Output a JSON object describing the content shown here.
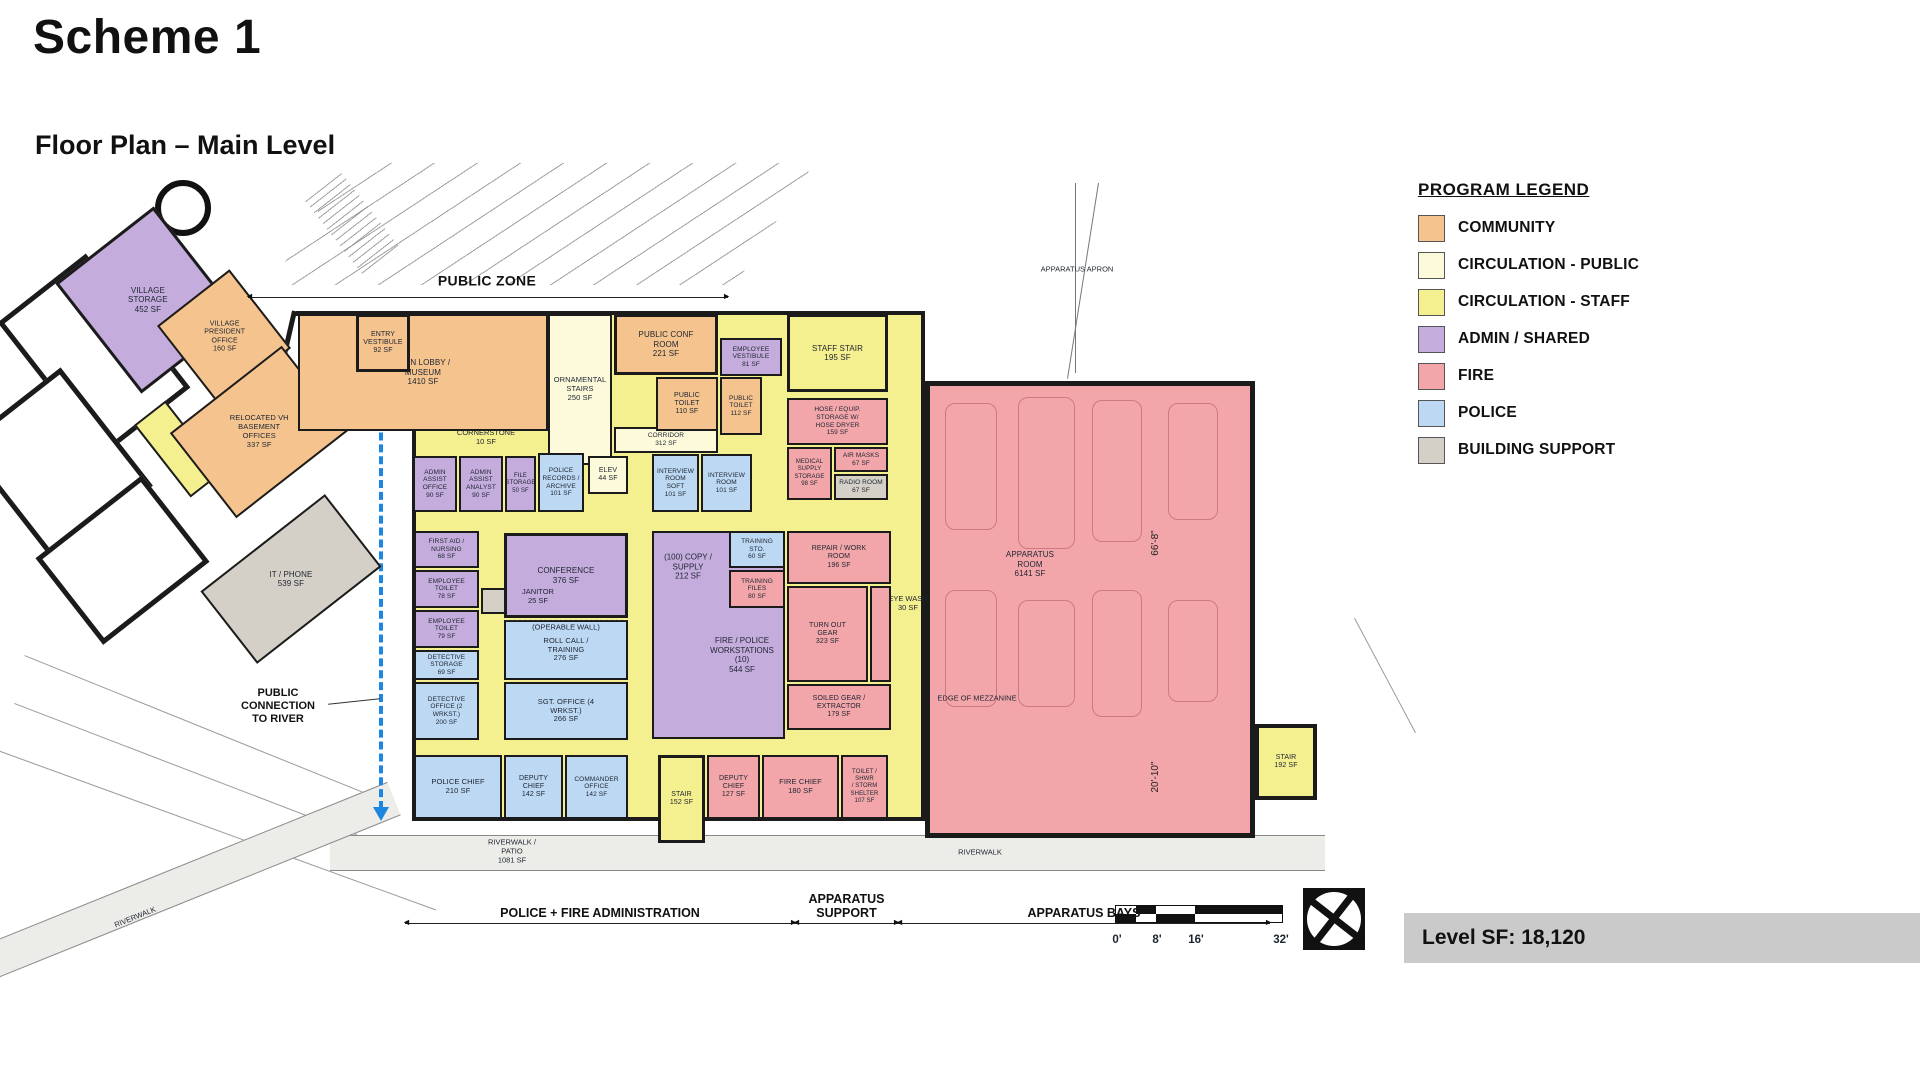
{
  "header": {
    "title": "Scheme 1",
    "subtitle": "Floor Plan – Main Level"
  },
  "footer": {
    "level_sf": "Level SF: 18,120"
  },
  "colors": {
    "community": "#F5C38E",
    "circ_public": "#FCFADB",
    "circ_staff": "#F4EF8F",
    "admin": "#C4ACDC",
    "fire": "#F3A6AA",
    "police": "#BCD8F3",
    "support": "#D4D0C7",
    "white": "#FFFFFF",
    "route_accent": "#1D86E0"
  },
  "legend": {
    "title": "PROGRAM LEGEND",
    "items": [
      {
        "key": "community",
        "label": "COMMUNITY"
      },
      {
        "key": "circ_public",
        "label": "CIRCULATION - PUBLIC"
      },
      {
        "key": "circ_staff",
        "label": "CIRCULATION - STAFF"
      },
      {
        "key": "admin",
        "label": "ADMIN / SHARED"
      },
      {
        "key": "fire",
        "label": "FIRE"
      },
      {
        "key": "police",
        "label": "POLICE"
      },
      {
        "key": "support",
        "label": "BUILDING SUPPORT"
      }
    ]
  },
  "scale_bar": {
    "ticks": [
      "0'",
      "8'",
      "16'",
      "32'"
    ]
  },
  "plan": {
    "rooms": [
      {
        "id": "circulation-staff-base",
        "label": "",
        "sf": "",
        "cat": "circ_staff",
        "x": 382,
        "y": 136,
        "w": 513,
        "h": 510,
        "wall": 4
      },
      {
        "id": "existing-hall-room-1",
        "label": "",
        "sf": "",
        "cat": "white",
        "x": 8,
        "y": 95,
        "w": 112,
        "h": 170,
        "rot": -38,
        "wall": 5
      },
      {
        "id": "existing-hall-room-2",
        "label": "",
        "sf": "",
        "cat": "white",
        "x": -35,
        "y": 215,
        "w": 125,
        "h": 150,
        "rot": -38,
        "wall": 5
      },
      {
        "id": "existing-hall-room-3",
        "label": "",
        "sf": "",
        "cat": "white",
        "x": 25,
        "y": 330,
        "w": 135,
        "h": 110,
        "rot": -38,
        "wall": 5
      },
      {
        "id": "village-storage",
        "label": "VILLAGE\nSTORAGE",
        "sf": "452 SF",
        "cat": "admin",
        "x": 55,
        "y": 55,
        "w": 125,
        "h": 140,
        "rot": -38,
        "wall": 3,
        "fs": 8
      },
      {
        "id": "village-president-office",
        "label": "VILLAGE\nPRESIDENT\nOFFICE",
        "sf": "160 SF",
        "cat": "community",
        "x": 148,
        "y": 112,
        "w": 92,
        "h": 100,
        "rot": -38,
        "fs": 7
      },
      {
        "id": "circ-staff-sliver",
        "label": "",
        "sf": "",
        "cat": "circ_staff",
        "x": 128,
        "y": 228,
        "w": 40,
        "h": 92,
        "rot": -38
      },
      {
        "id": "relocated-vh-basement-offices",
        "label": "RELOCATED VH\nBASEMENT\nOFFICES",
        "sf": "337 SF",
        "cat": "community",
        "x": 158,
        "y": 203,
        "w": 142,
        "h": 108,
        "rot": -38,
        "fs": 7.5
      },
      {
        "id": "it-phone",
        "label": "IT / PHONE",
        "sf": "539 SF",
        "cat": "support",
        "x": 182,
        "y": 358,
        "w": 158,
        "h": 92,
        "rot": -38,
        "fs": 8
      },
      {
        "id": "main-lobby-museum",
        "label": "MAIN LOBBY /\nMUSEUM",
        "sf": "1410 SF",
        "cat": "community",
        "x": 268,
        "y": 139,
        "w": 250,
        "h": 117,
        "fs": 8
      },
      {
        "id": "entry-vestibule",
        "label": "ENTRY\nVESTIBULE",
        "sf": "92 SF",
        "cat": "community",
        "x": 326,
        "y": 139,
        "w": 54,
        "h": 58,
        "wall": 3,
        "fs": 7
      },
      {
        "id": "ornamental-stairs",
        "label": "ORNAMENTAL\nSTAIRS",
        "sf": "250 SF",
        "cat": "circ_public",
        "x": 518,
        "y": 139,
        "w": 64,
        "h": 151,
        "fs": 7.5
      },
      {
        "id": "public-conf-room",
        "label": "PUBLIC CONF\nROOM",
        "sf": "221 SF",
        "cat": "community",
        "x": 584,
        "y": 139,
        "w": 104,
        "h": 61,
        "wall": 3,
        "fs": 8
      },
      {
        "id": "employee-vestibule",
        "label": "EMPLOYEE\nVESTIBULE",
        "sf": "81 SF",
        "cat": "admin",
        "x": 690,
        "y": 163,
        "w": 62,
        "h": 38,
        "fs": 6.5
      },
      {
        "id": "corridor",
        "label": "CORRIDOR",
        "sf": "312 SF",
        "cat": "circ_public",
        "x": 584,
        "y": 252,
        "w": 104,
        "h": 26,
        "fs": 6.5
      },
      {
        "id": "public-toilet-1",
        "label": "PUBLIC\nTOILET",
        "sf": "110 SF",
        "cat": "community",
        "x": 626,
        "y": 202,
        "w": 62,
        "h": 54,
        "fs": 7
      },
      {
        "id": "public-toilet-2",
        "label": "PUBLIC\nTOILET",
        "sf": "112 SF",
        "cat": "community",
        "x": 690,
        "y": 202,
        "w": 42,
        "h": 58,
        "fs": 6.5
      },
      {
        "id": "staff-stair",
        "label": "STAFF STAIR",
        "sf": "195 SF",
        "cat": "circ_staff",
        "x": 757,
        "y": 139,
        "w": 101,
        "h": 78,
        "wall": 3,
        "fs": 8
      },
      {
        "id": "hose-equip-storage",
        "label": "HOSE / EQUIP.\nSTORAGE W/\nHOSE DRYER",
        "sf": "159 SF",
        "cat": "fire",
        "x": 757,
        "y": 223,
        "w": 101,
        "h": 47,
        "fs": 6.5
      },
      {
        "id": "medical-supply-storage",
        "label": "MEDICAL\nSUPPLY\nSTORAGE",
        "sf": "98 SF",
        "cat": "fire",
        "x": 757,
        "y": 272,
        "w": 45,
        "h": 53,
        "fs": 6
      },
      {
        "id": "air-masks",
        "label": "AIR MASKS",
        "sf": "67 SF",
        "cat": "fire",
        "x": 804,
        "y": 272,
        "w": 54,
        "h": 25,
        "fs": 6.5
      },
      {
        "id": "radio-room",
        "label": "RADIO ROOM",
        "sf": "67 SF",
        "cat": "support",
        "x": 804,
        "y": 299,
        "w": 54,
        "h": 26,
        "fs": 6.5
      },
      {
        "id": "admin-assist-office",
        "label": "ADMIN\nASSIST\nOFFICE",
        "sf": "90 SF",
        "cat": "admin",
        "x": 383,
        "y": 281,
        "w": 44,
        "h": 56,
        "fs": 6.5
      },
      {
        "id": "admin-assist-analyst",
        "label": "ADMIN\nASSIST\nANALYST",
        "sf": "90 SF",
        "cat": "admin",
        "x": 429,
        "y": 281,
        "w": 44,
        "h": 56,
        "fs": 6.5
      },
      {
        "id": "file-storage",
        "label": "FILE\nSTORAGE",
        "sf": "50 SF",
        "cat": "admin",
        "x": 475,
        "y": 281,
        "w": 31,
        "h": 56,
        "fs": 6
      },
      {
        "id": "police-records-archive",
        "label": "POLICE\nRECORDS /\nARCHIVE",
        "sf": "101 SF",
        "cat": "police",
        "x": 508,
        "y": 278,
        "w": 46,
        "h": 59,
        "fs": 6.5
      },
      {
        "id": "elevator",
        "label": "ELEV",
        "sf": "44 SF",
        "cat": "circ_public",
        "x": 558,
        "y": 281,
        "w": 40,
        "h": 38,
        "fs": 7
      },
      {
        "id": "interview-room-soft",
        "label": "INTERVIEW\nROOM\nSOFT",
        "sf": "101 SF",
        "cat": "police",
        "x": 622,
        "y": 279,
        "w": 47,
        "h": 58,
        "fs": 6.5
      },
      {
        "id": "interview-room",
        "label": "INTERVIEW\nROOM",
        "sf": "101 SF",
        "cat": "police",
        "x": 671,
        "y": 279,
        "w": 51,
        "h": 58,
        "fs": 6.5
      },
      {
        "id": "first-aid-nursing",
        "label": "FIRST AID /\nNURSING",
        "sf": "68 SF",
        "cat": "admin",
        "x": 384,
        "y": 356,
        "w": 65,
        "h": 37,
        "fs": 6.5
      },
      {
        "id": "employee-toilet-1",
        "label": "EMPLOYEE\nTOILET",
        "sf": "78 SF",
        "cat": "admin",
        "x": 384,
        "y": 395,
        "w": 65,
        "h": 38,
        "fs": 6.5
      },
      {
        "id": "employee-toilet-2",
        "label": "EMPLOYEE\nTOILET",
        "sf": "79 SF",
        "cat": "admin",
        "x": 384,
        "y": 435,
        "w": 65,
        "h": 38,
        "fs": 6.5
      },
      {
        "id": "janitor-closet",
        "label": "",
        "sf": "",
        "cat": "support",
        "x": 451,
        "y": 413,
        "w": 26,
        "h": 26
      },
      {
        "id": "detective-storage",
        "label": "DETECTIVE\nSTORAGE",
        "sf": "69 SF",
        "cat": "police",
        "x": 384,
        "y": 475,
        "w": 65,
        "h": 30,
        "fs": 6.5
      },
      {
        "id": "detective-office",
        "label": "DETECTIVE\nOFFICE (2\nWRKST.)",
        "sf": "200 SF",
        "cat": "police",
        "x": 384,
        "y": 507,
        "w": 65,
        "h": 58,
        "fs": 6.5
      },
      {
        "id": "conference",
        "label": "CONFERENCE",
        "sf": "376 SF",
        "cat": "admin",
        "x": 474,
        "y": 358,
        "w": 124,
        "h": 85,
        "wall": 3,
        "fs": 8
      },
      {
        "id": "roll-call-training",
        "label": "ROLL CALL /\nTRAINING",
        "sf": "276 SF",
        "cat": "police",
        "x": 474,
        "y": 445,
        "w": 124,
        "h": 60,
        "fs": 7.5
      },
      {
        "id": "sgt-office",
        "label": "SGT. OFFICE (4\nWRKST.)",
        "sf": "266 SF",
        "cat": "police",
        "x": 474,
        "y": 507,
        "w": 124,
        "h": 58,
        "fs": 7.5
      },
      {
        "id": "copy-supply-workstations",
        "label": "",
        "sf": "",
        "cat": "admin",
        "x": 622,
        "y": 356,
        "w": 133,
        "h": 208
      },
      {
        "id": "training-storage",
        "label": "TRAINING\nSTO.",
        "sf": "60 SF",
        "cat": "police",
        "x": 699,
        "y": 356,
        "w": 56,
        "h": 37,
        "fs": 6.5
      },
      {
        "id": "training-files",
        "label": "TRAINING\nFILES",
        "sf": "80 SF",
        "cat": "fire",
        "x": 699,
        "y": 395,
        "w": 56,
        "h": 38,
        "fs": 6.5
      },
      {
        "id": "repair-work-room",
        "label": "REPAIR / WORK\nROOM",
        "sf": "196 SF",
        "cat": "fire",
        "x": 757,
        "y": 356,
        "w": 104,
        "h": 53,
        "fs": 7
      },
      {
        "id": "turn-out-gear",
        "label": "TURN OUT\nGEAR",
        "sf": "323 SF",
        "cat": "fire",
        "x": 757,
        "y": 411,
        "w": 81,
        "h": 96,
        "fs": 7
      },
      {
        "id": "eye-wash-alcove",
        "label": "",
        "sf": "",
        "cat": "fire",
        "x": 840,
        "y": 411,
        "w": 21,
        "h": 96
      },
      {
        "id": "soiled-gear-extractor",
        "label": "SOILED GEAR /\nEXTRACTOR",
        "sf": "179 SF",
        "cat": "fire",
        "x": 757,
        "y": 509,
        "w": 104,
        "h": 46,
        "fs": 7
      },
      {
        "id": "apparatus-room",
        "label": "APPARATUS\nROOM",
        "sf": "6141 SF",
        "cat": "fire",
        "x": 895,
        "y": 206,
        "w": 330,
        "h": 457,
        "wall": 5,
        "fs": 8,
        "lx": -60,
        "ly": -45
      },
      {
        "id": "stair-192",
        "label": "STAIR",
        "sf": "192 SF",
        "cat": "circ_staff",
        "x": 1225,
        "y": 549,
        "w": 62,
        "h": 76,
        "wall": 4,
        "fs": 7
      },
      {
        "id": "police-chief",
        "label": "POLICE CHIEF",
        "sf": "210 SF",
        "cat": "police",
        "x": 384,
        "y": 580,
        "w": 88,
        "h": 64,
        "fs": 7.5
      },
      {
        "id": "deputy-chief-police",
        "label": "DEPUTY\nCHIEF",
        "sf": "142 SF",
        "cat": "police",
        "x": 474,
        "y": 580,
        "w": 59,
        "h": 64,
        "fs": 7
      },
      {
        "id": "commander-office",
        "label": "COMMANDER\nOFFICE",
        "sf": "142 SF",
        "cat": "police",
        "x": 535,
        "y": 580,
        "w": 63,
        "h": 64,
        "fs": 6.5
      },
      {
        "id": "stair-152",
        "label": "STAIR",
        "sf": "152 SF",
        "cat": "circ_staff",
        "x": 628,
        "y": 580,
        "w": 47,
        "h": 88,
        "wall": 3,
        "fs": 7
      },
      {
        "id": "deputy-chief-fire",
        "label": "DEPUTY\nCHIEF",
        "sf": "127 SF",
        "cat": "fire",
        "x": 677,
        "y": 580,
        "w": 53,
        "h": 64,
        "fs": 7
      },
      {
        "id": "fire-chief",
        "label": "FIRE CHIEF",
        "sf": "180 SF",
        "cat": "fire",
        "x": 732,
        "y": 580,
        "w": 77,
        "h": 64,
        "fs": 7.5
      },
      {
        "id": "toilet-shwr-storm-shelter",
        "label": "TOILET / SHWR\n/ STORM\nSHELTER",
        "sf": "107 SF",
        "cat": "fire",
        "x": 811,
        "y": 580,
        "w": 47,
        "h": 64,
        "fs": 6
      }
    ],
    "annotations": [
      {
        "text": "PUBLIC ZONE",
        "x": 457,
        "y": 106,
        "cls": "zone"
      },
      {
        "text": "APPARATUS APRON",
        "x": 1047,
        "y": 94,
        "cls": "tiny"
      },
      {
        "text": "CORNERSTONE\n10 SF",
        "x": 456,
        "y": 262,
        "cls": "tiny"
      },
      {
        "text": "JANITOR\n25 SF",
        "x": 508,
        "y": 421,
        "cls": "tiny"
      },
      {
        "text": "(OPERABLE WALL)",
        "x": 536,
        "y": 452,
        "cls": "tiny"
      },
      {
        "text": "EYE WASH\n30 SF",
        "x": 878,
        "y": 428,
        "cls": "tiny"
      },
      {
        "text": "(100) COPY /\nSUPPLY\n212 SF",
        "x": 658,
        "y": 392,
        "cls": "small"
      },
      {
        "text": "FIRE / POLICE\nWORKSTATIONS\n(10)\n544 SF",
        "x": 712,
        "y": 480,
        "cls": "small"
      },
      {
        "text": "EDGE OF MEZZANINE",
        "x": 947,
        "y": 523,
        "cls": "tiny"
      },
      {
        "text": "66'-8\"",
        "x": 1126,
        "y": 368,
        "cls": "dimv",
        "rot": -90
      },
      {
        "text": "20'-10\"",
        "x": 1126,
        "y": 602,
        "cls": "dimv",
        "rot": -90
      },
      {
        "text": "PUBLIC\nCONNECTION\nTO RIVER",
        "x": 248,
        "y": 532,
        "cls": "note"
      },
      {
        "text": "RIVERWALK /\nPATIO\n1081 SF",
        "x": 482,
        "y": 676,
        "cls": "tiny"
      },
      {
        "text": "RIVERWALK",
        "x": 950,
        "y": 677,
        "cls": "tiny"
      },
      {
        "text": "RIVERWALK",
        "x": 105,
        "y": 742,
        "cls": "tiny",
        "rot": -22
      },
      {
        "text": "0'",
        "x": 1087,
        "y": 766,
        "cls": "tick"
      },
      {
        "text": "8'",
        "x": 1127,
        "y": 766,
        "cls": "tick"
      },
      {
        "text": "16'",
        "x": 1166,
        "y": 766,
        "cls": "tick"
      },
      {
        "text": "32'",
        "x": 1251,
        "y": 766,
        "cls": "tick"
      }
    ],
    "dims": [
      {
        "label": "",
        "x": 218,
        "y": 122,
        "w": 480
      },
      {
        "label": "POLICE + FIRE ADMINISTRATION",
        "x": 375,
        "y": 748,
        "w": 390
      },
      {
        "label": "APPARATUS\nSUPPORT",
        "x": 765,
        "y": 748,
        "w": 103
      },
      {
        "label": "APPARATUS BAYS",
        "x": 868,
        "y": 748,
        "w": 372
      }
    ]
  }
}
